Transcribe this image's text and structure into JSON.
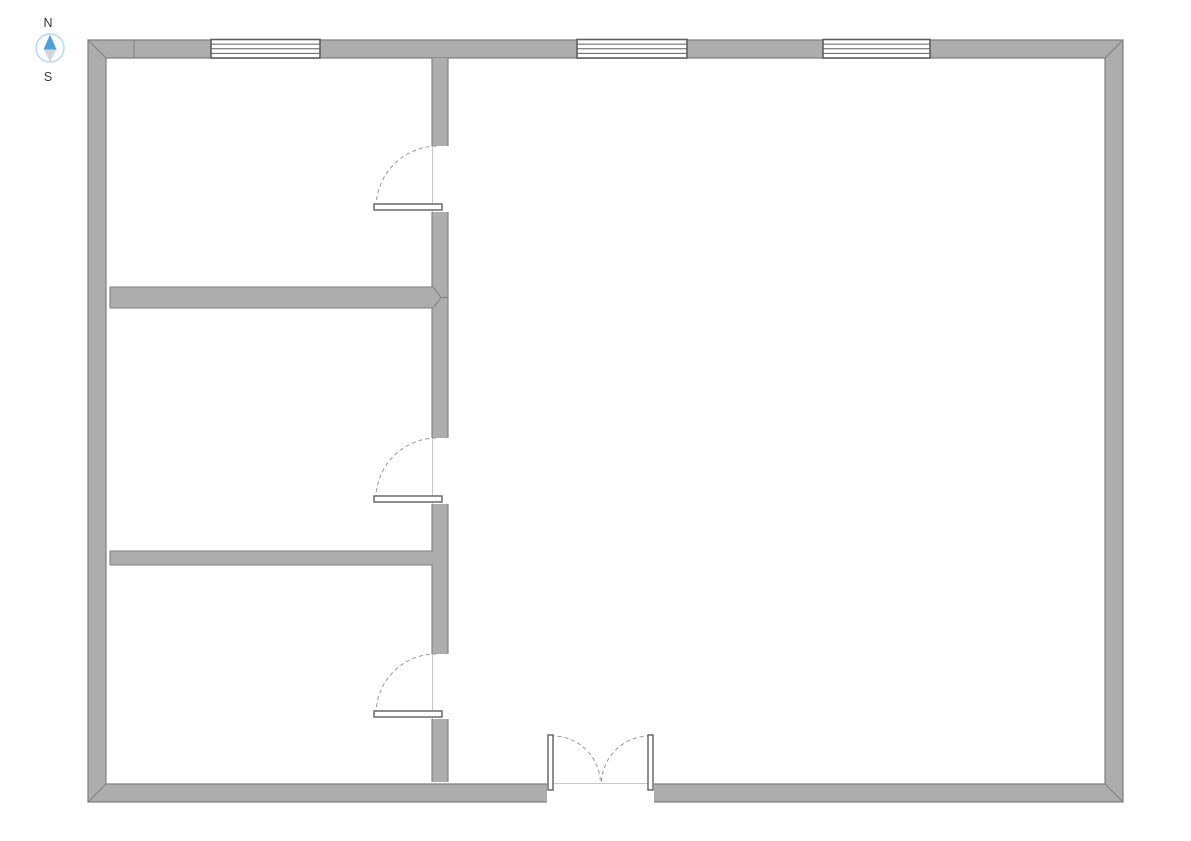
{
  "compass": {
    "north_label": "N",
    "south_label": "S",
    "cx": 50,
    "cy": 48,
    "radius": 14,
    "label_x": 48,
    "north_label_y": 27,
    "south_label_y": 81,
    "needle_north_points": "50,34.5 43.5,49.5 56.5,49.5",
    "needle_south_points": "43.5,49.5 56.5,49.5 50,62"
  },
  "floorplan": {
    "canvas": {
      "width": 1191,
      "height": 841
    },
    "colors": {
      "wall_fill": "#ADADAD",
      "wall_edge": "#7F7F7F",
      "window_frame": "#5F5F5F",
      "door_frame": "#5F5F5F",
      "swing_arc": "#9A9A9A",
      "jamb_line": "#C9C9C9",
      "white": "#FFFFFF",
      "compass_ring": "#AFD9F4",
      "compass_north": "#4AA0DA",
      "compass_south": "#D3D6DA",
      "label_text": "#3A3A3A"
    },
    "outer_wall": {
      "name": "exterior-wall",
      "outer": [
        88,
        40,
        1123,
        802
      ],
      "inner": [
        106,
        58,
        1105,
        784
      ]
    },
    "corner_miters": [
      [
        88,
        40,
        106,
        58
      ],
      [
        1123,
        40,
        1105,
        58
      ],
      [
        1123,
        802,
        1105,
        784
      ],
      [
        88,
        802,
        106,
        784
      ]
    ],
    "wall_seams": [
      [
        134,
        40.5,
        134,
        57.5
      ]
    ],
    "windows": [
      {
        "name": "window-north-left",
        "x": 211,
        "y": 39.5,
        "w": 109,
        "h": 18.5
      },
      {
        "name": "window-north-middle",
        "x": 577,
        "y": 39.5,
        "w": 110,
        "h": 18.5
      },
      {
        "name": "window-north-right",
        "x": 823,
        "y": 39.5,
        "w": 107,
        "h": 18.5
      }
    ],
    "interior_walls": [
      {
        "name": "interior-wall-vertical-top",
        "x": 432,
        "y": 58,
        "w": 16,
        "h": 88,
        "edges": [
          "left",
          "right"
        ]
      },
      {
        "name": "interior-wall-vertical-mid-upper",
        "x": 432,
        "y": 212,
        "w": 16,
        "h": 226,
        "edges": [
          "left",
          "right"
        ]
      },
      {
        "name": "interior-wall-vertical-mid-lower",
        "x": 432,
        "y": 504,
        "w": 16,
        "h": 150,
        "edges": [
          "left",
          "right"
        ]
      },
      {
        "name": "interior-wall-vertical-bottom",
        "x": 432,
        "y": 719,
        "w": 16,
        "h": 63,
        "edges": [
          "left",
          "right"
        ]
      },
      {
        "name": "interior-wall-horizontal-upper",
        "x": 110,
        "y": 287,
        "w": 324,
        "h": 21,
        "edges": [
          "top",
          "bottom",
          "left"
        ]
      },
      {
        "name": "interior-wall-horizontal-lower",
        "x": 110,
        "y": 551,
        "w": 323,
        "h": 14,
        "edges": [
          "top",
          "bottom",
          "left"
        ]
      }
    ],
    "joint_lines": [
      [
        434,
        288,
        441,
        297.5
      ],
      [
        434,
        307,
        441,
        297.5
      ],
      [
        441,
        297.5,
        448,
        297.5
      ]
    ],
    "doors": [
      {
        "name": "door-upper",
        "jamb": [
          432.5,
          146,
          432.5,
          212
        ],
        "leaf": {
          "x": 374,
          "y": 204,
          "w": 68,
          "h": 6
        },
        "arc": {
          "sx": 376,
          "sy": 207,
          "ex": 438,
          "ey": 146,
          "r": 62,
          "sweep": 1
        }
      },
      {
        "name": "door-middle",
        "jamb": [
          432.5,
          438,
          432.5,
          504
        ],
        "leaf": {
          "x": 374,
          "y": 496,
          "w": 68,
          "h": 6
        },
        "arc": {
          "sx": 376,
          "sy": 499,
          "ex": 438,
          "ey": 438,
          "r": 61,
          "sweep": 1
        }
      },
      {
        "name": "door-lower",
        "jamb": [
          432.5,
          654,
          432.5,
          719
        ],
        "leaf": {
          "x": 374,
          "y": 711,
          "w": 68,
          "h": 6
        },
        "arc": {
          "sx": 376,
          "sy": 714,
          "ex": 438,
          "ey": 654,
          "r": 60,
          "sweep": 1
        }
      }
    ],
    "double_door": {
      "name": "double-door-south",
      "gap": {
        "x": 547,
        "y": 783.2,
        "w": 107,
        "h": 20
      },
      "jamb": [
        548,
        783.5,
        653,
        783.5
      ],
      "leaves": [
        {
          "x": 548,
          "y": 735,
          "w": 5,
          "h": 55
        },
        {
          "x": 648,
          "y": 735,
          "w": 5,
          "h": 55
        }
      ],
      "arcs": [
        {
          "sx": 550.5,
          "sy": 736,
          "ex": 600.5,
          "ey": 783,
          "r": 48,
          "sweep": 1
        },
        {
          "sx": 650.5,
          "sy": 736,
          "ex": 601.5,
          "ey": 783,
          "r": 48,
          "sweep": 0
        }
      ]
    }
  }
}
